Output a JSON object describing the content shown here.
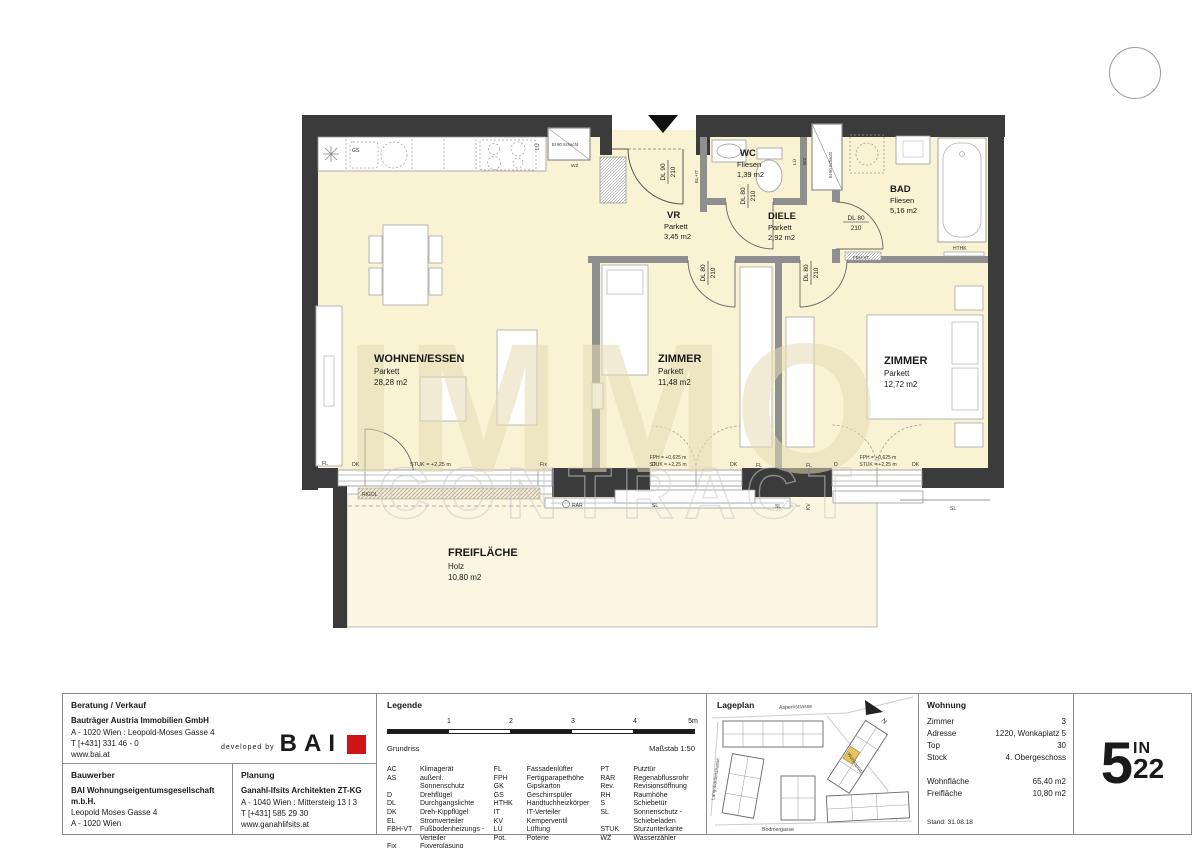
{
  "colors": {
    "wall_dark": "#3b3b3b",
    "wall_gray": "#8f8f8f",
    "floor_cream": "#faf3d3",
    "terrace_cream": "#fbf6e2",
    "accent_red": "#cf1418",
    "lageplan_highlight": "#e7c35f"
  },
  "watermark": {
    "line1": "IMMO",
    "line2": "CONTRACT"
  },
  "plan": {
    "rooms": [
      {
        "name": "WOHNEN/ESSEN",
        "floor": "Parkett",
        "area": "28,28 m2"
      },
      {
        "name": "ZIMMER",
        "floor": "Parkett",
        "area": "11,48 m2"
      },
      {
        "name": "ZIMMER",
        "floor": "Parkett",
        "area": "12,72 m2"
      },
      {
        "name": "VR",
        "floor": "Parkett",
        "area": "3,45 m2"
      },
      {
        "name": "DIELE",
        "floor": "Parkett",
        "area": "2,92 m2"
      },
      {
        "name": "WC",
        "floor": "Fliesen",
        "area": "1,39 m2"
      },
      {
        "name": "BAD",
        "floor": "Fliesen",
        "area": "5,16 m2"
      },
      {
        "name": "FREIFLÄCHE",
        "floor": "Holz",
        "area": "10,80 m2"
      }
    ],
    "ann": {
      "dl90": "DL 90",
      "dl80": "DL 80",
      "h210": "210",
      "shaft": "EI 90 Schacht",
      "wz": "WZ",
      "lu": "LÜ",
      "gs": "GS",
      "el_it": "EL+IT",
      "fbh_vt": "FBH-VT",
      "hthk": "HTHK",
      "fl": "FL",
      "dk": "DK",
      "d": "D",
      "fix": "Fix",
      "stuk": "STUK = +2,25 m",
      "fph": "FPH = +0,625 m",
      "rigol": "RIGOL",
      "rar": "RAR",
      "sl": "SL",
      "kv": "KV"
    }
  },
  "titleblock": {
    "beratung": {
      "title": "Beratung / Verkauf",
      "company": "Bauträger Austria Immobilien GmbH",
      "line1": "A - 1020 Wien : Leopold-Moses Gasse 4",
      "line2": "T [+431] 331 46 - 0",
      "line3": "www.bai.at"
    },
    "bai": {
      "prefix": "developed by",
      "name": "BAI"
    },
    "bauwerber": {
      "title": "Bauwerber",
      "company1": "BAI Wohnungseigentumsgesellschaft",
      "company2": "m.b.H.",
      "line1": "Leopold Moses Gasse 4",
      "line2": "A - 1020 Wien"
    },
    "planung": {
      "title": "Planung",
      "company": "Ganahl-Ifsits Architekten ZT-KG",
      "line1": "A - 1040 Wien : Mittersteig 13 I 3",
      "line2": "T [+431] 585 29 30",
      "line3": "www.ganahlifsits.at"
    },
    "legende": {
      "title": "Legende",
      "ticks": [
        "1",
        "2",
        "3",
        "4",
        "5m"
      ],
      "drawing": "Grundriss",
      "scale": "Maßstab 1:50",
      "cols": [
        [
          [
            "AC",
            "Klimagerät"
          ],
          [
            "AS",
            "außenl. Sonnenschutz"
          ],
          [
            "D",
            "Drehflügel"
          ],
          [
            "DL",
            "Durchgangslichte"
          ],
          [
            "DK",
            "Dreh-Kippflügel"
          ],
          [
            "EL",
            "Stromverteiler"
          ],
          [
            "FBH-VT",
            "Fußbodenheizungs -"
          ],
          [
            "",
            "Verteiler"
          ],
          [
            "Fix",
            "Fixverglasung"
          ]
        ],
        [
          [
            "FL",
            "Fassadenlüfter"
          ],
          [
            "FPH",
            "Fertigparapethöhe"
          ],
          [
            "GK",
            "Gipskarton"
          ],
          [
            "GS",
            "Geschirrspüler"
          ],
          [
            "HTHK",
            "Handtuchheizkörper"
          ],
          [
            "IT",
            "IT-Verteiler"
          ],
          [
            "KV",
            "Kemperventil"
          ],
          [
            "LÜ",
            "Lüftung"
          ],
          [
            "Pot.",
            "Poterie"
          ]
        ],
        [
          [
            "PT",
            "Putztür"
          ],
          [
            "RAR",
            "Regenabflussrohr"
          ],
          [
            "Rev.",
            "Revisionsöffnung"
          ],
          [
            "RH",
            "Raumhöhe"
          ],
          [
            "S",
            "Schiebetür"
          ],
          [
            "SL",
            "Sonnenschutz -"
          ],
          [
            "",
            "Schiebeladen"
          ],
          [
            "STUK",
            "Sturzunterkante"
          ],
          [
            "WZ",
            "Wasserzähler"
          ]
        ]
      ]
    },
    "lageplan": {
      "title": "Lageplan",
      "street_top": "Aspernstrasse",
      "street_bottom": "Bodmergasse",
      "street_left": "Langobardenstrasse",
      "street_diag": "Wonkaplatz",
      "north": "N"
    },
    "wohnung": {
      "title": "Wohnung",
      "rows": [
        {
          "label": "Zimmer",
          "value": "3"
        },
        {
          "label": "Adresse",
          "value": "1220, Wonkaplatz 5"
        },
        {
          "label": "Top",
          "value": "30"
        },
        {
          "label": "Stock",
          "value": "4. Obergeschoss"
        },
        {
          "label": "Wohnfläche",
          "value": "65,40 m2",
          "gap": true
        },
        {
          "label": "Freifläche",
          "value": "10,80 m2"
        }
      ],
      "stand": "Stand: 31.08.18"
    },
    "logo": {
      "big": "5",
      "sup": "IN",
      "sub": "22"
    }
  }
}
